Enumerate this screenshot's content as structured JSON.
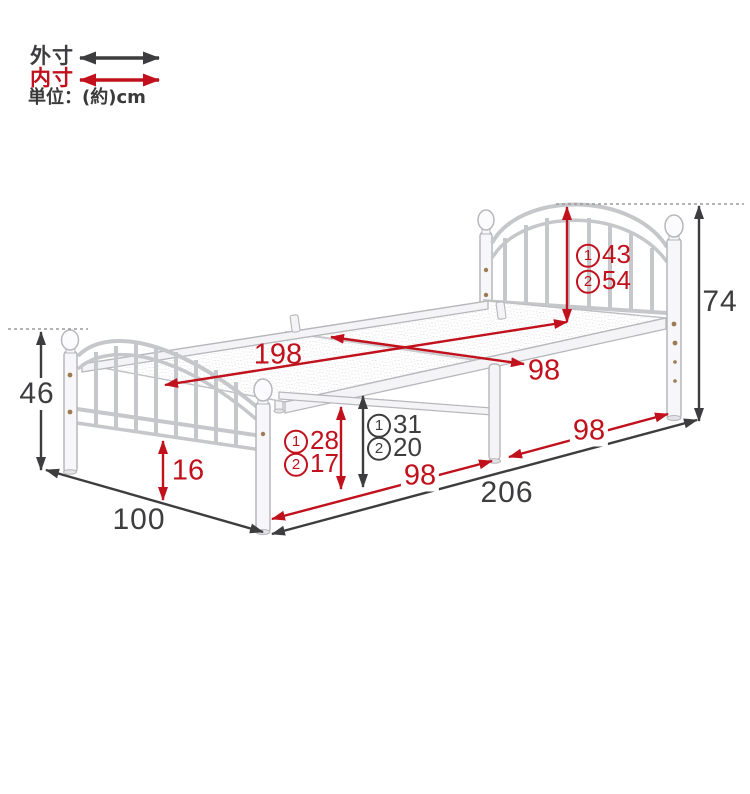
{
  "legend": {
    "outer": {
      "label": "外寸"
    },
    "inner": {
      "label": "内寸"
    },
    "unit": {
      "label": "単位：(約)cm"
    }
  },
  "colors": {
    "outer_dim": "#3d3d3f",
    "inner_dim": "#c0111c"
  },
  "dimensions": {
    "inner_length": {
      "value": "198"
    },
    "inner_width": {
      "value": "98"
    },
    "headboard_inner_height": {
      "option1": {
        "step": "1",
        "value": "43"
      },
      "option2": {
        "step": "2",
        "value": "54"
      }
    },
    "outer_height_headboard": {
      "value": "74"
    },
    "outer_height_footboard": {
      "value": "46"
    },
    "footboard_floor_gap": {
      "value": "16"
    },
    "under_bed_clearance": {
      "option1": {
        "step": "1",
        "value": "28"
      },
      "option2": {
        "step": "2",
        "value": "17"
      }
    },
    "platform_top_height": {
      "option1": {
        "step": "1",
        "value": "31"
      },
      "option2": {
        "step": "2",
        "value": "20"
      }
    },
    "floor_span_left": {
      "value": "98"
    },
    "floor_span_right": {
      "value": "98"
    },
    "outer_width": {
      "value": "100"
    },
    "outer_length": {
      "value": "206"
    }
  }
}
